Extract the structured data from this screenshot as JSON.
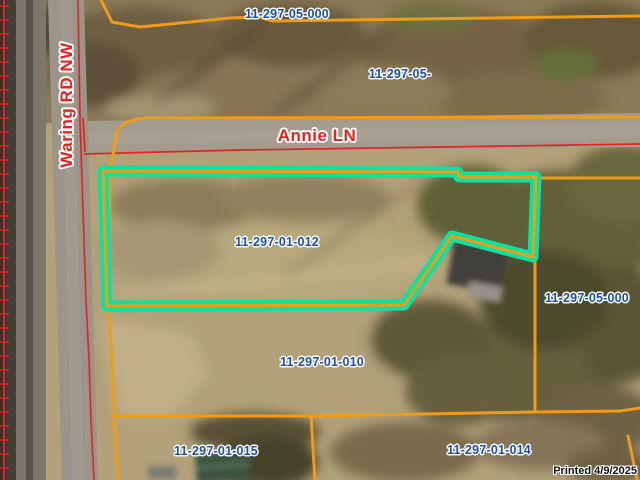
{
  "map": {
    "parcel_labels": [
      {
        "id": "11-297-05-000",
        "position": "top"
      },
      {
        "id": "11-297-05-",
        "position": "upper-right-truncated"
      },
      {
        "id": "11-297-01-012",
        "position": "selected-parcel-center"
      },
      {
        "id": "11-297-01-010",
        "position": "center-lower"
      },
      {
        "id": "11-297-05-000",
        "position": "right"
      },
      {
        "id": "11-297-01-015",
        "position": "bottom-left"
      },
      {
        "id": "11-297-01-014",
        "position": "bottom-right"
      }
    ],
    "street_labels": [
      {
        "name": "Annie LN",
        "orientation": "horizontal"
      },
      {
        "name": "Waring RD NW",
        "orientation": "vertical"
      }
    ],
    "selected_parcel_id": "11-297-01-012",
    "printed_note": "Printed 4/9/2025",
    "colors": {
      "parcel_boundary": "#ef9c1b",
      "selection_highlight": "#0ce1a0",
      "street_label": "#e8231f",
      "parcel_label": "#1d4fa3",
      "railroad_and_road_lines": "#e02522",
      "printed_text": "#111111"
    }
  }
}
